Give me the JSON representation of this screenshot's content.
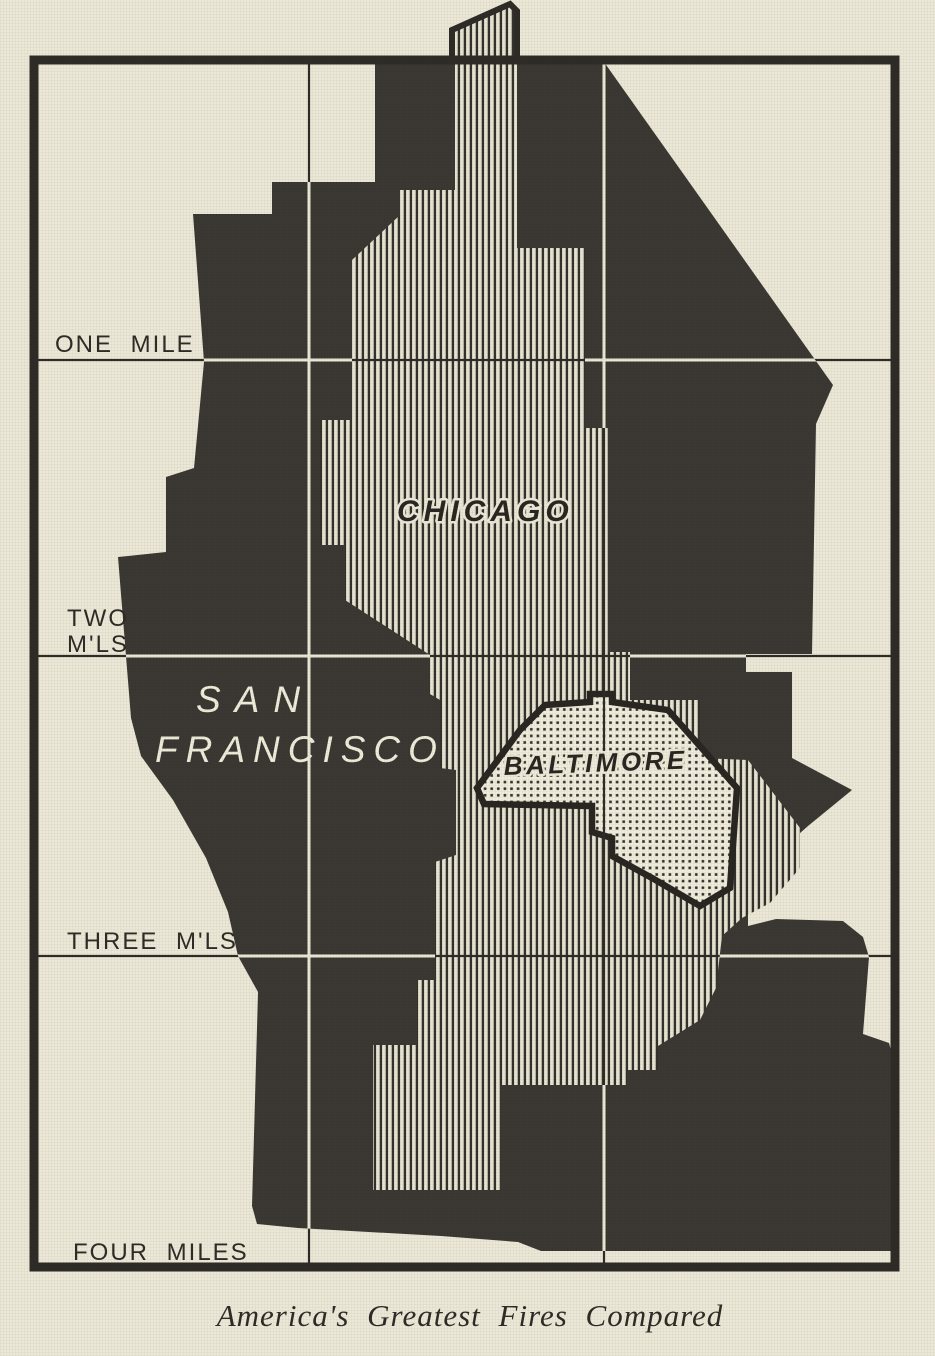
{
  "map": {
    "caption": "America's Greatest Fires Compared",
    "scale_labels": {
      "one_mile": "ONE MILE",
      "two_line1": "TWO",
      "two_line2": "M'LS",
      "three_mls": "THREE M'LS",
      "four_miles": "FOUR MILES"
    },
    "regions": {
      "chicago": {
        "label": "CHICAGO",
        "fill_style": "vertical-hatch"
      },
      "san_francisco": {
        "label_line1": "SAN",
        "label_line2": "FRANCISCO",
        "fill_style": "solid-dark"
      },
      "baltimore": {
        "label": "BALTIMORE",
        "fill_style": "dotted-outlined"
      }
    },
    "grid": {
      "visible_columns": 3,
      "visible_rows": 4,
      "cell_represents": "one square mile"
    },
    "colors": {
      "paper": "#ECE8D7",
      "ink": "#35322D",
      "knockout_line": "#ECE8D7"
    }
  }
}
